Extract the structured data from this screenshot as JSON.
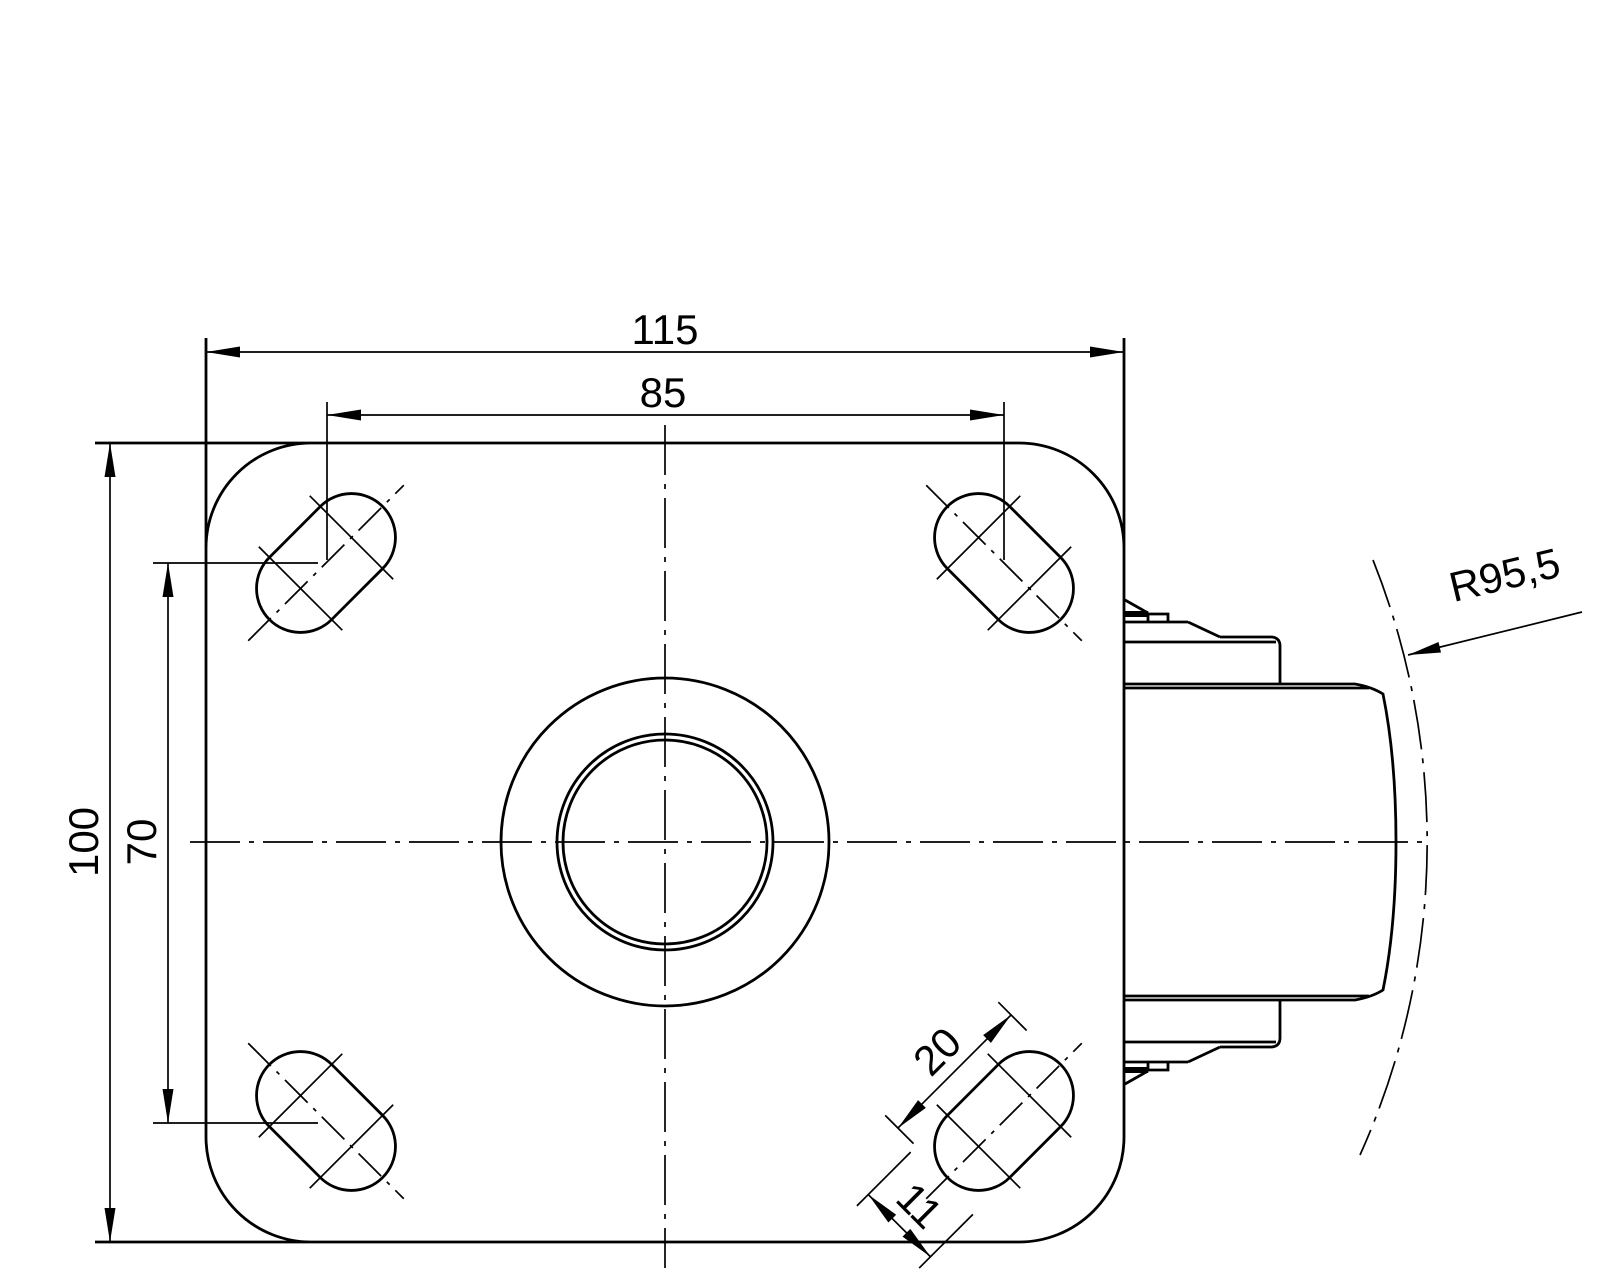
{
  "drawing": {
    "title": "caster-top-plate-technical-drawing",
    "colors": {
      "line": "#000000",
      "background": "#ffffff"
    },
    "dimensions": {
      "plate_width": "115",
      "hole_spacing_width": "85",
      "plate_height": "100",
      "hole_spacing_height": "70",
      "slot_length": "20",
      "slot_width": "11",
      "swivel_radius": "R95,5"
    }
  }
}
